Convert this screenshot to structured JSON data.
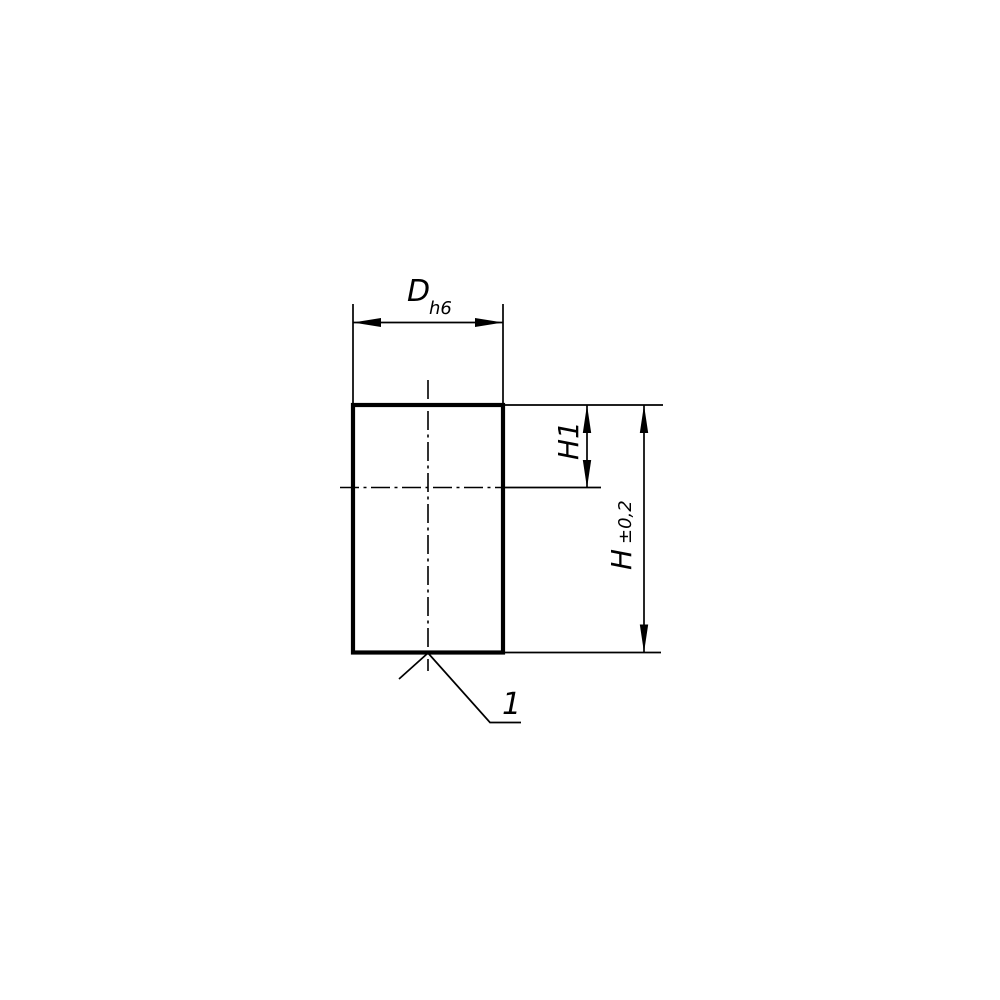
{
  "theme": {
    "line-color": "#000000",
    "bg-color": "#ffffff"
  },
  "drawing": {
    "kind": "technical-dimension-drawing",
    "part": "rectangular side view of cylindrical part",
    "labels": {
      "width_dim": "D",
      "width_fit": "h6",
      "inner_height_dim": "H1",
      "height_dim": "H",
      "height_tolerance": "±0,2",
      "leader_ref": "1"
    }
  }
}
